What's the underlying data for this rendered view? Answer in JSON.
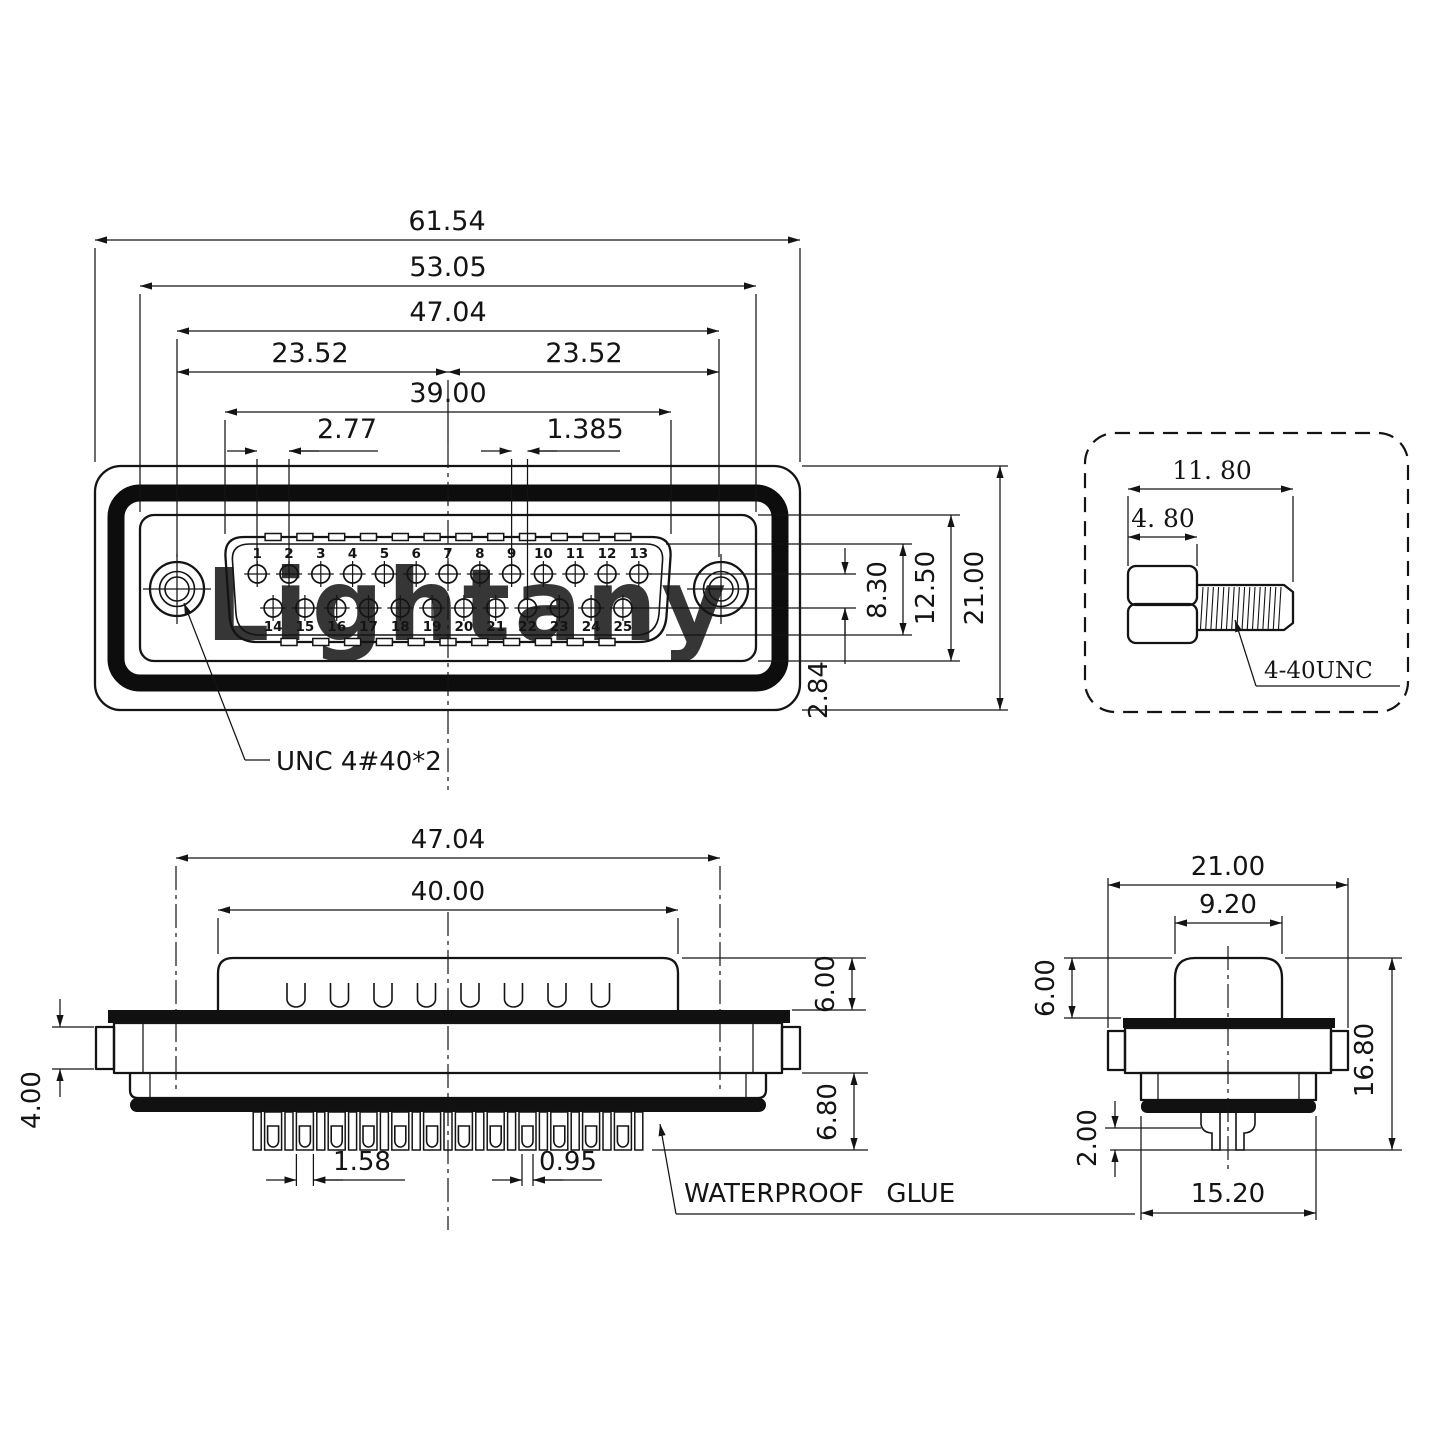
{
  "watermark": {
    "text": "Lightany",
    "color": "#f6d0d0"
  },
  "front_view": {
    "dims": {
      "total_width": "61.54",
      "shell_width": "53.05",
      "mount_span": "47.04",
      "mount_half_left": "23.52",
      "mount_half_right": "23.52",
      "opening_width": "39.00",
      "pin_pitch": "2.77",
      "pin_half_pitch": "1.385",
      "pin_row_span": "8.30",
      "recess_height": "12.50",
      "body_height": "21.00",
      "row_offset": "2.84"
    },
    "screw_label": "UNC 4#40*2",
    "pins_top": [
      "1",
      "2",
      "3",
      "4",
      "5",
      "6",
      "7",
      "8",
      "9",
      "10",
      "11",
      "12",
      "13"
    ],
    "pins_bottom": [
      "14",
      "15",
      "16",
      "17",
      "18",
      "19",
      "20",
      "21",
      "22",
      "23",
      "24",
      "25"
    ]
  },
  "screw_detail": {
    "dims": {
      "total_length": "11. 80",
      "head_length": "4. 80"
    },
    "thread_label": "4-40UNC"
  },
  "side_view": {
    "dims": {
      "mount_span": "47.04",
      "shell_width": "40.00",
      "shell_height": "6.00",
      "flange_tab": "4.00",
      "lower_height": "6.80",
      "pin_width": "1.58",
      "pin_gap": "0.95"
    },
    "glue_label": "WATERPROOF GLUE"
  },
  "end_view": {
    "dims": {
      "flange_width": "21.00",
      "shell_width": "9.20",
      "shell_height": "6.00",
      "total_height": "16.80",
      "pin_step": "2.00",
      "glue_width": "15.20"
    }
  }
}
